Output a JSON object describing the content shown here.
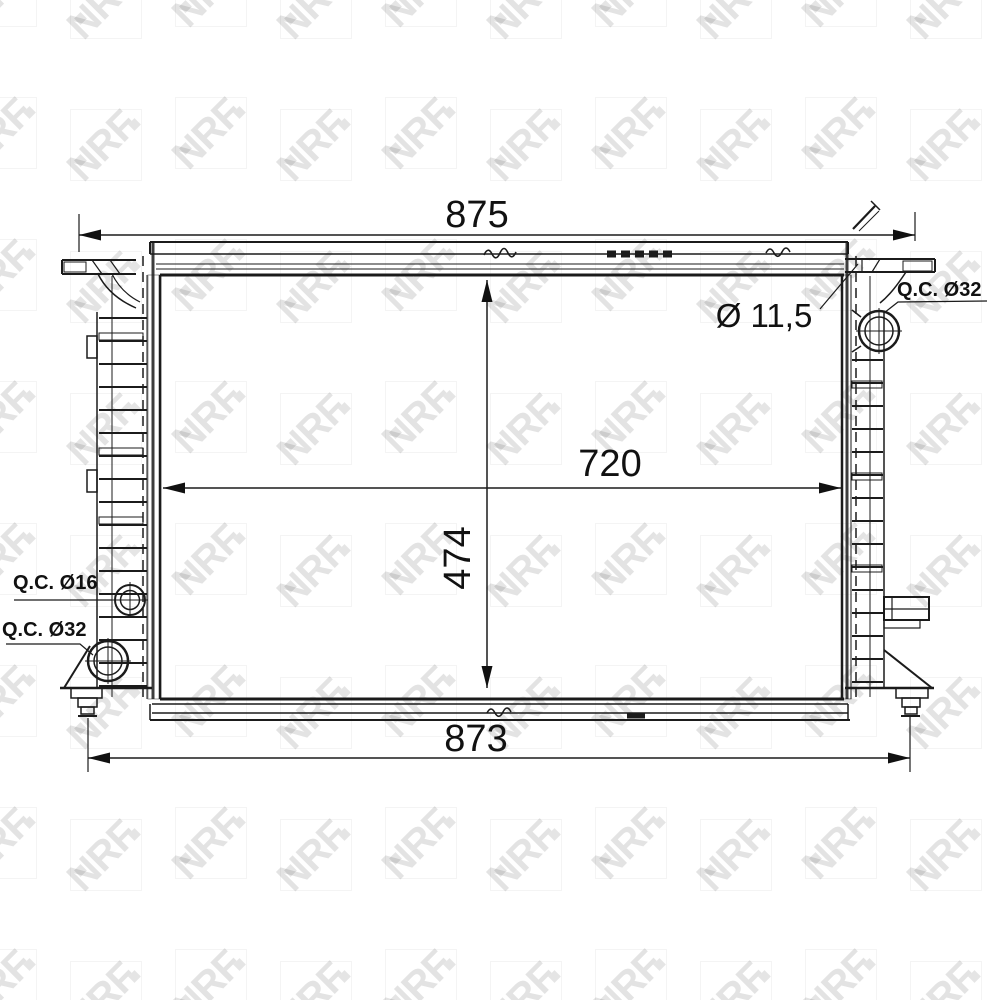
{
  "watermark": {
    "brand": "NRF"
  },
  "drawing": {
    "type": "radiator-technical-drawing",
    "dimensions": {
      "overall_width_top": "875",
      "core_width": "720",
      "core_height": "474",
      "overall_width_bottom": "873"
    },
    "annotations": {
      "pin_hole_diameter": "Ø 11,5",
      "port_top_right": "Q.C. Ø32",
      "port_left_upper": "Q.C. Ø16",
      "port_left_lower": "Q.C. Ø32"
    }
  }
}
